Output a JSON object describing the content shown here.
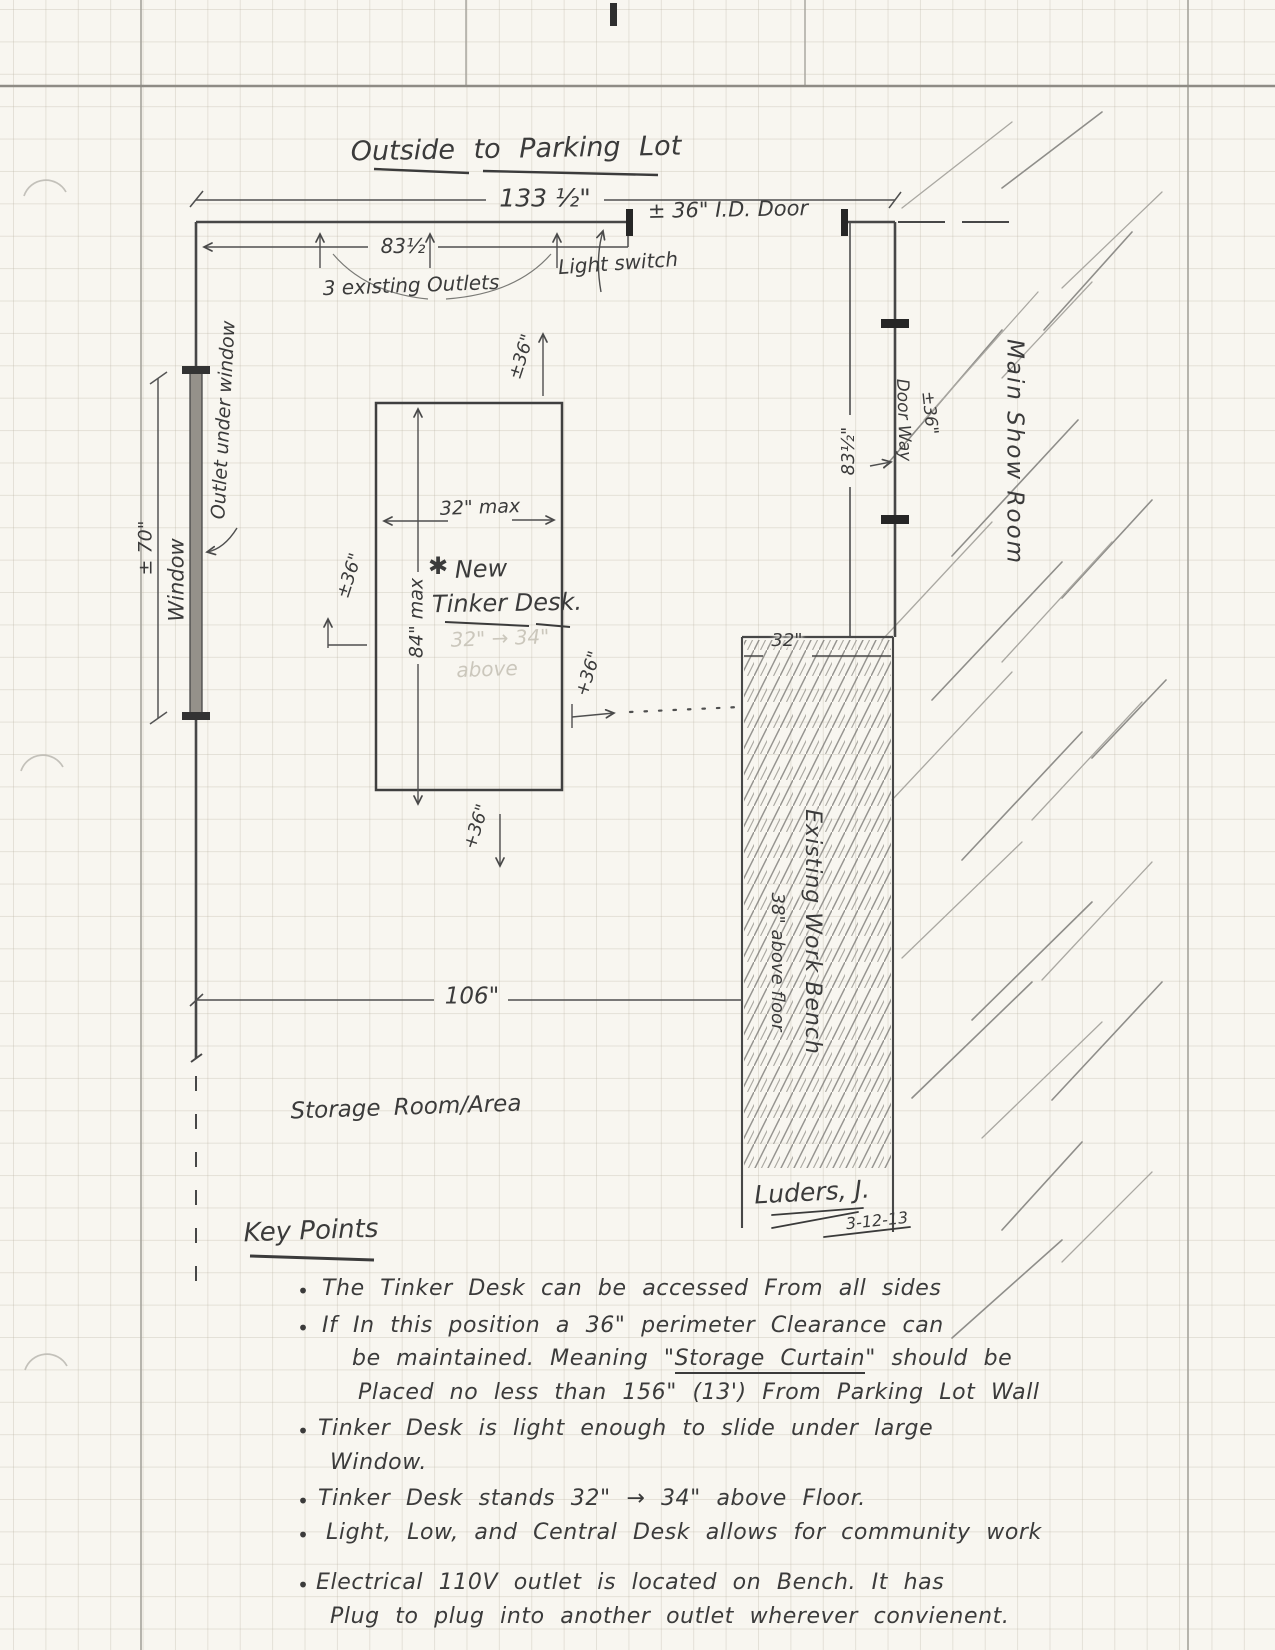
{
  "title": "Outside to Parking Lot",
  "dims": {
    "overall_width": "133 ½\"",
    "outlets_span": "83½",
    "outlets": "3 existing Outlets",
    "light_switch": "Light switch",
    "door": "± 36\" I.D. Door",
    "window_height": "± 70\"",
    "wall_right": "83½\"",
    "doorway_dim": "±36\"",
    "bench_width": "32\"",
    "storage_width": "106\""
  },
  "labels": {
    "outlet_under_window": "Outlet under window",
    "window": "Window",
    "door_way": "Door Way",
    "main_show_room": "Main Show Room",
    "bench_line1": "Existing Work Bench",
    "bench_height": "38\" above floor",
    "storage_room": "Storage Room/Area"
  },
  "desk": {
    "star": "✱",
    "name_line1": "New",
    "name_line2": "Tinker Desk.",
    "width": "32\" max",
    "depth": "84\" max",
    "erased_line1": "32\" → 34\"",
    "erased_line2": "above",
    "clearance_top": "±36\"",
    "clearance_left": "±36\"",
    "clearance_right": "+36\"",
    "clearance_bottom": "+36\""
  },
  "signature": {
    "name": "Luders, J.",
    "date": "3-12-13"
  },
  "key_points": {
    "heading": "Key Points",
    "bullet_glyph": "•",
    "lines": [
      {
        "text": "The Tinker Desk can be accessed From all sides"
      },
      {
        "text": "If In this position a 36\" perimeter Clearance can"
      },
      {
        "pre": "be maintained. Meaning \"",
        "underline": "Storage Curtain",
        "post": "\" should be"
      },
      {
        "text": "Placed no less than 156\" (13') From Parking Lot Wall"
      },
      {
        "text": "Tinker Desk is light enough to slide under large"
      },
      {
        "text": "Window."
      },
      {
        "text": "Tinker Desk stands 32\" → 34\" above Floor."
      },
      {
        "text": "Light, Low, and Central Desk allows for community work"
      },
      {
        "text": "Electrical 110V outlet is located on Bench. It has"
      },
      {
        "text": "Plug to plug into another outlet wherever convienent."
      }
    ]
  }
}
